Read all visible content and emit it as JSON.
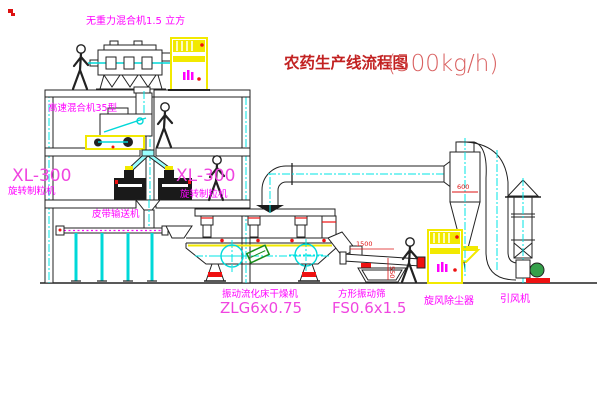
{
  "title": {
    "cn": "农药生产线流程图",
    "capacity": "(500kg/h)"
  },
  "labels": {
    "gravity_mixer": "无重力混合机1.5 立方",
    "speed_mixer": "高速混合机35型",
    "granulator_left_model": "XL-300",
    "granulator_left_name": "旋转制粒机",
    "granulator_center_model": "XL-300",
    "granulator_center_name": "旋转制粒机",
    "belt_conveyor": "皮带输送机",
    "dryer_name": "振动流化床干燥机",
    "dryer_model": "ZLG6x0.75",
    "sieve_name": "方形振动筛",
    "sieve_model": "FS0.6x1.5",
    "cyclone": "旋风除尘器",
    "fan": "引风机"
  },
  "dimensions": {
    "sieve_width": "1500",
    "sieve_height": "550",
    "cyclone_diameter": "600"
  },
  "colors": {
    "label_magenta": "#ff00ff",
    "title_red": "#c22222",
    "centerline_cyan": "#00e5e5",
    "highlight_yellow": "#f2e900",
    "dimension_red": "#dd1111"
  }
}
